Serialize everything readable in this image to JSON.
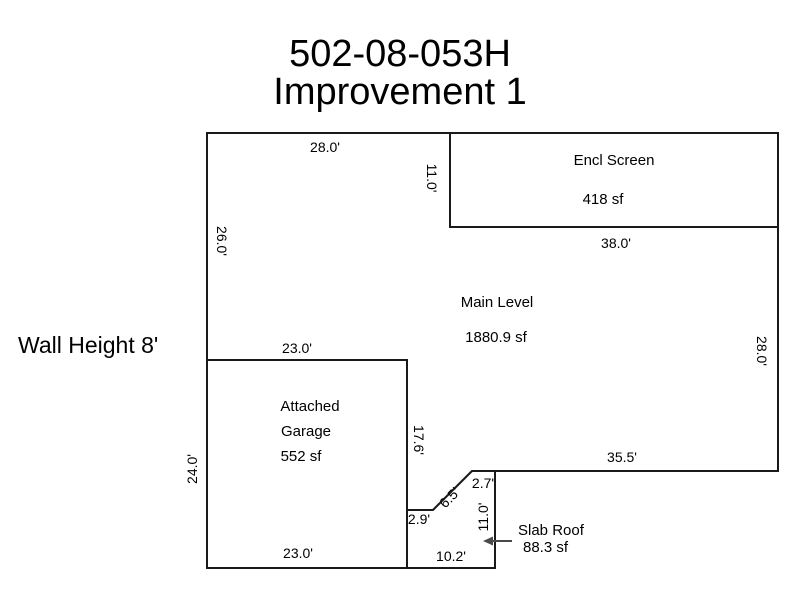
{
  "title": {
    "line1": "502-08-053H",
    "line2": "Improvement 1"
  },
  "wall_height": {
    "label": "Wall Height 8'"
  },
  "areas": {
    "encl_screen": {
      "name": "Encl Screen",
      "area": "418 sf"
    },
    "main_level": {
      "name": "Main Level",
      "area": "1880.9 sf"
    },
    "attached_garage": {
      "name_line1": "Attached",
      "name_line2": "Garage",
      "area": "552 sf"
    },
    "slab_roof": {
      "name": "Slab Roof",
      "area": "88.3 sf"
    }
  },
  "dimensions": {
    "main_top": "28.0'",
    "encl_screen_left": "11.0'",
    "encl_screen_bottom": "38.0'",
    "main_left": "26.0'",
    "main_right": "28.0'",
    "main_bottom": "35.5'",
    "garage_top": "23.0'",
    "garage_left": "24.0'",
    "garage_right": "17.6'",
    "garage_bottom": "23.0'",
    "notch_horizontal": "2.9'",
    "notch_diagonal": "6.5'",
    "slab_top": "2.7'",
    "slab_right": "11.0'",
    "slab_bottom": "10.2'"
  },
  "colors": {
    "line": "#1a1a1a",
    "text": "#000000",
    "arrow": "#4a4a4a",
    "background": "#ffffff"
  }
}
